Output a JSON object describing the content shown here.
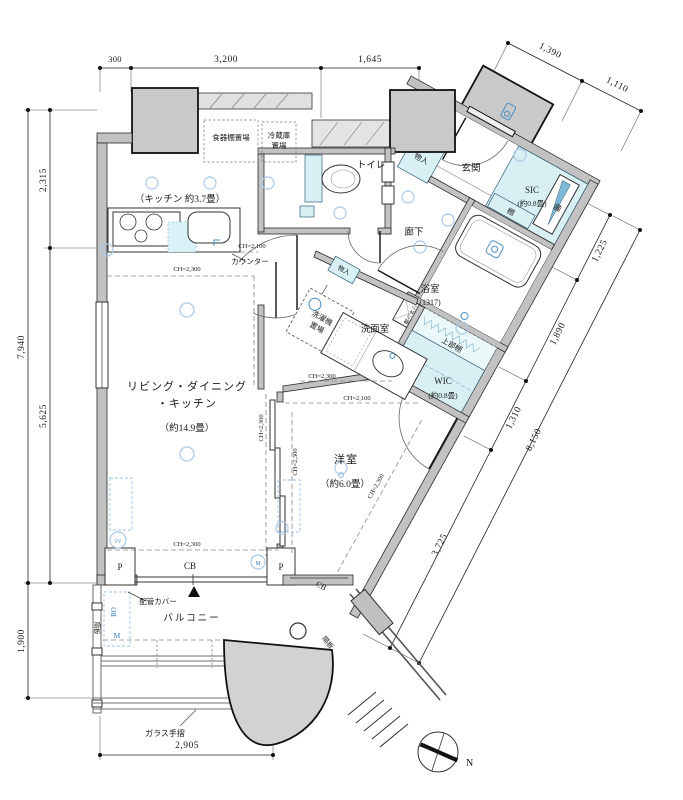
{
  "rooms": {
    "ldk_line1": "リビング・ダイニング",
    "ldk_line2": "・キッチン",
    "ldk_size": "（約14.9畳）",
    "kitchen": "（キッチン 約3.7畳）",
    "western": "洋室",
    "western_size": "（約6.0畳）",
    "toilet": "トイレ",
    "entrance": "玄関",
    "hallway": "廊下",
    "washroom": "洗面室",
    "bathroom": "浴室",
    "bathroom_size": "(1317)",
    "sic": "SIC",
    "sic_size": "(約0.8畳)",
    "wic": "WIC",
    "wic_size": "(約0.8畳)",
    "balcony": "バルコニー"
  },
  "features": {
    "dish_shelf": "食器棚置場",
    "fridge_line1": "冷蔵庫",
    "fridge_line2": "置場",
    "counter": "カウンター",
    "storage": "物入",
    "shelf": "棚",
    "upper_shelf": "上部棚",
    "linen": "リネン庫",
    "washer_line1": "洗濯機",
    "washer_line2": "置場",
    "pipe_cover": "配管カバー",
    "partition": "隔板",
    "glass_rail": "ガラス手摺",
    "cb": "CB",
    "p": "P",
    "bo": "BO",
    "m": "M",
    "tv": "TV",
    "t": "T"
  },
  "ceiling": {
    "ch2100": "CH=2,100",
    "ch2300": "CH=2,300"
  },
  "dims": {
    "top": [
      "300",
      "3,200",
      "1,645"
    ],
    "top_right": [
      "1,390",
      "1,110"
    ],
    "left": [
      "2,315",
      "7,940",
      "5,625",
      "1,900"
    ],
    "right": [
      "1,225",
      "1,890",
      "1,310",
      "3,725",
      "8,150"
    ],
    "bottom": [
      "2,905"
    ]
  },
  "compass": {
    "north": "N"
  }
}
